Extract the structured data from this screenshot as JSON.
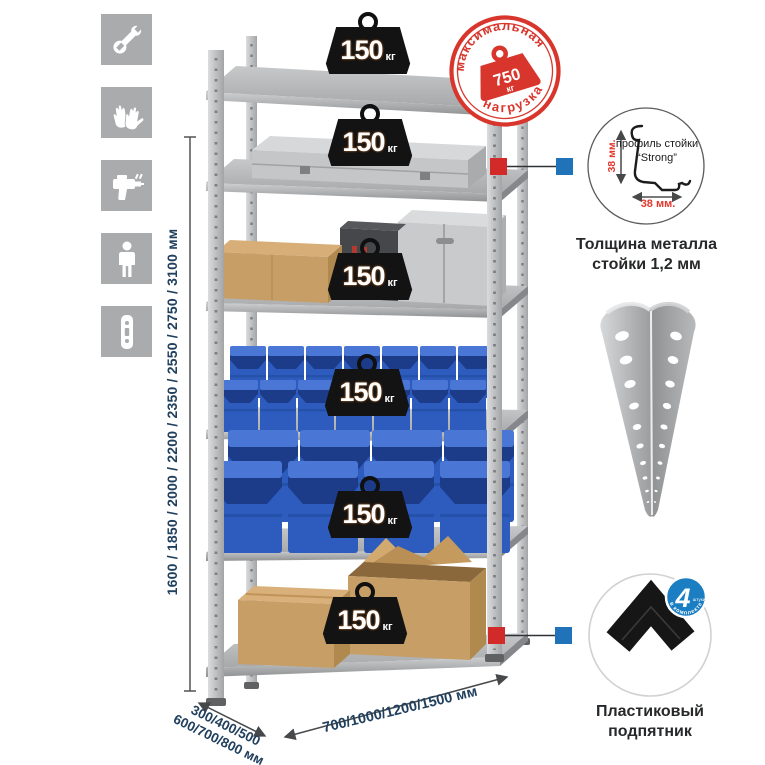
{
  "colors": {
    "stamp_red": "#d8362c",
    "dimension_text": "#20405e",
    "red_label": "#e2382d",
    "connector_red": "#d22a28",
    "connector_blue": "#2173b9",
    "badge_blue": "#1b7ec2",
    "icon_bg": "#a9abad",
    "weight_black": "#131313",
    "bin_blue": "#2e5cbe",
    "metal_gray": "#b5b7b9",
    "cardboard": "#c79e66"
  },
  "left_icons": [
    {
      "name": "wrench"
    },
    {
      "name": "work-gloves"
    },
    {
      "name": "drill"
    },
    {
      "name": "person-height"
    },
    {
      "name": "perforated-post"
    }
  ],
  "height_dimension": {
    "label": "1600 / 1850 / 2000 / 2200 / 2350 / 2550 / 2750 / 3100 мм"
  },
  "depth_dimension": {
    "line1": "300/400/500",
    "line2": "600/700/800 мм"
  },
  "width_dimension": {
    "label": "700/1000/1200/1500 мм"
  },
  "shelf_weights": [
    {
      "value": "150",
      "unit": "кг"
    },
    {
      "value": "150",
      "unit": "кг"
    },
    {
      "value": "150",
      "unit": "кг"
    },
    {
      "value": "150",
      "unit": "кг"
    },
    {
      "value": "150",
      "unit": "кг"
    },
    {
      "value": "150",
      "unit": "кг"
    }
  ],
  "max_load_stamp": {
    "arc_top": "максимальная",
    "arc_bottom": "нагрузка",
    "value": "750",
    "unit": "кг"
  },
  "profile_detail": {
    "line1": "профиль",
    "line2": "стойки",
    "line3": "“Strong”",
    "vertical_dim": "38 мм.",
    "horizontal_dim": "38 мм.",
    "caption_line1": "Толщина металла",
    "caption_line2": "стойки 1,2 мм"
  },
  "foot_detail": {
    "badge_number": "4",
    "badge_word": "штуки",
    "badge_arc": "в комплекте",
    "caption_line1": "Пластиковый",
    "caption_line2": "подпятник"
  }
}
